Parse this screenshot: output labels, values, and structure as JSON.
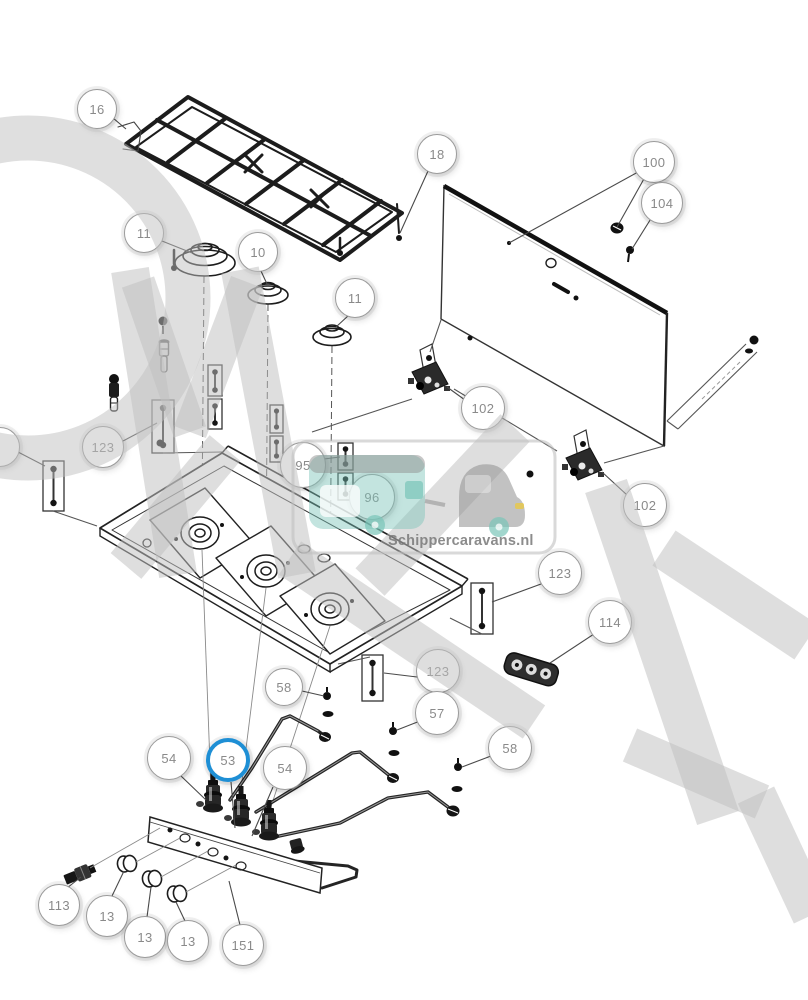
{
  "brand": {
    "watermark_text": "Schippercaravans.nl"
  },
  "colors": {
    "highlight": "#1e8fd5",
    "callout_border": "#9b9b9b",
    "callout_text": "#8a8a8a",
    "watermark_gray": "#bfbfbf",
    "teal": "#79c4b8",
    "yellow": "#e6c84e",
    "line_art": "#1c1c1c",
    "background": "#ffffff"
  },
  "callouts": [
    {
      "label": "16",
      "x": 97,
      "y": 109,
      "r": 20,
      "highlighted": false
    },
    {
      "label": "18",
      "x": 437,
      "y": 154,
      "r": 20,
      "highlighted": false
    },
    {
      "label": "11",
      "x": 144,
      "y": 233,
      "r": 20,
      "highlighted": false
    },
    {
      "label": "10",
      "x": 258,
      "y": 252,
      "r": 20,
      "highlighted": false
    },
    {
      "label": "11",
      "x": 355,
      "y": 298,
      "r": 20,
      "highlighted": false
    },
    {
      "label": "100",
      "x": 654,
      "y": 162,
      "r": 21,
      "highlighted": false
    },
    {
      "label": "104",
      "x": 662,
      "y": 203,
      "r": 21,
      "highlighted": false
    },
    {
      "label": "102",
      "x": 483,
      "y": 408,
      "r": 22,
      "highlighted": false
    },
    {
      "label": "102",
      "x": 645,
      "y": 505,
      "r": 22,
      "highlighted": false
    },
    {
      "label": "123",
      "x": 103,
      "y": 447,
      "r": 21,
      "highlighted": false
    },
    {
      "label": "",
      "x": 0,
      "y": 447,
      "r": 20,
      "highlighted": false
    },
    {
      "label": "95",
      "x": 303,
      "y": 465,
      "r": 23,
      "highlighted": false
    },
    {
      "label": "96",
      "x": 372,
      "y": 497,
      "r": 23,
      "highlighted": false
    },
    {
      "label": "123",
      "x": 560,
      "y": 573,
      "r": 22,
      "highlighted": false
    },
    {
      "label": "114",
      "x": 610,
      "y": 622,
      "r": 22,
      "highlighted": false
    },
    {
      "label": "123",
      "x": 438,
      "y": 671,
      "r": 22,
      "highlighted": false
    },
    {
      "label": "58",
      "x": 284,
      "y": 687,
      "r": 19,
      "highlighted": false
    },
    {
      "label": "57",
      "x": 437,
      "y": 713,
      "r": 22,
      "highlighted": false
    },
    {
      "label": "58",
      "x": 510,
      "y": 748,
      "r": 22,
      "highlighted": false
    },
    {
      "label": "54",
      "x": 169,
      "y": 758,
      "r": 22,
      "highlighted": false
    },
    {
      "label": "53",
      "x": 228,
      "y": 760,
      "r": 22,
      "highlighted": true
    },
    {
      "label": "54",
      "x": 285,
      "y": 768,
      "r": 22,
      "highlighted": false
    },
    {
      "label": "113",
      "x": 59,
      "y": 905,
      "r": 21,
      "highlighted": false
    },
    {
      "label": "13",
      "x": 107,
      "y": 916,
      "r": 21,
      "highlighted": false
    },
    {
      "label": "13",
      "x": 145,
      "y": 937,
      "r": 21,
      "highlighted": false
    },
    {
      "label": "13",
      "x": 188,
      "y": 941,
      "r": 21,
      "highlighted": false
    },
    {
      "label": "151",
      "x": 243,
      "y": 945,
      "r": 21,
      "highlighted": false
    }
  ]
}
